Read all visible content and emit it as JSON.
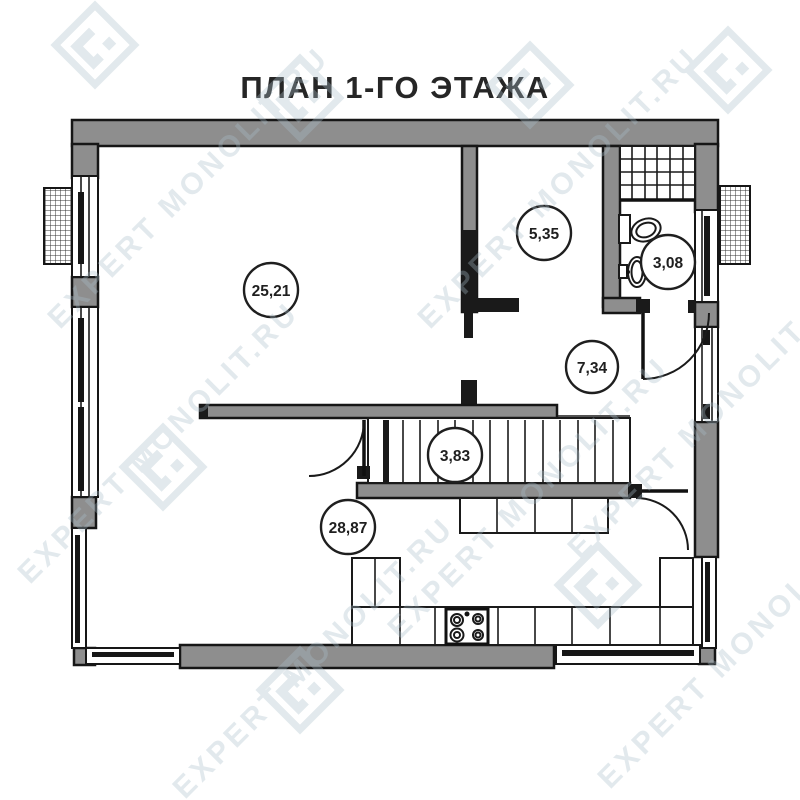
{
  "title": "ПЛАН 1-ГО ЭТАЖА",
  "watermark": {
    "text": "EXPERT MONOLIT.RU",
    "color": "#a9bdc9"
  },
  "colors": {
    "wall_gray": "#8e8e8e",
    "line_black": "#1a1a1a",
    "background": "#ffffff"
  },
  "rooms": [
    {
      "name": "living-room",
      "area": "25,21"
    },
    {
      "name": "upper-room",
      "area": "5,35"
    },
    {
      "name": "bathroom",
      "area": "3,08"
    },
    {
      "name": "hallway",
      "area": "7,34"
    },
    {
      "name": "staircase",
      "area": "3,83"
    },
    {
      "name": "kitchen-living",
      "area": "28,87"
    }
  ],
  "icons": {
    "stove": "4-burner cooktop glyph",
    "toilet": "toilet plan glyph",
    "sink": "wash basin plan glyph",
    "shower": "tiled shower grid",
    "ac_unit": "hatched exterior unit",
    "logo": "diamond logo stamp"
  }
}
